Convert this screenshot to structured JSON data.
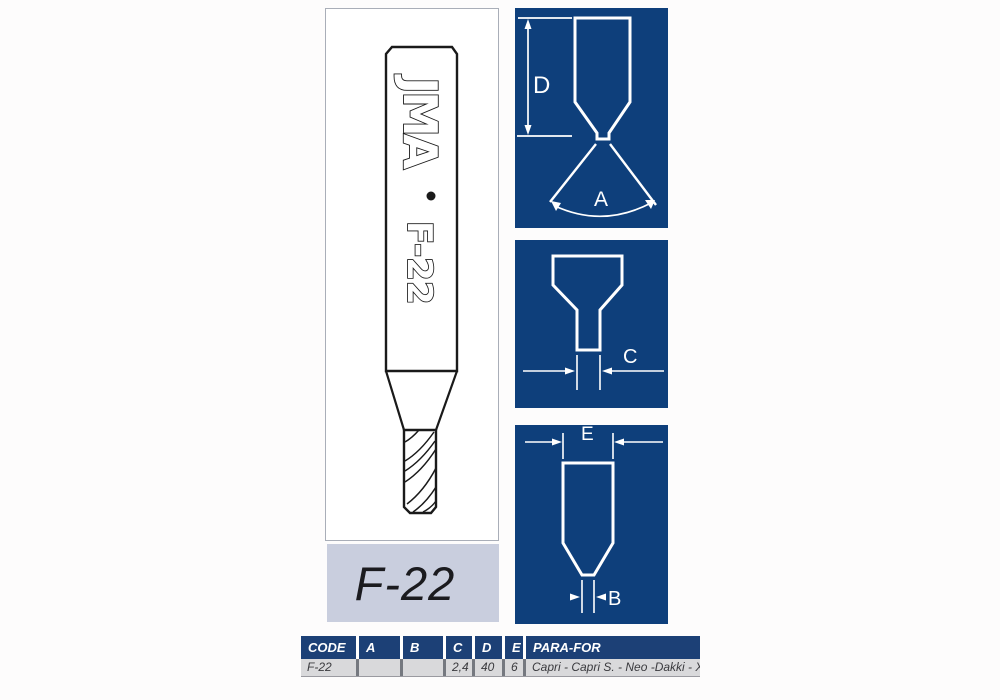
{
  "product": {
    "brand": "JMA",
    "model": "F-22",
    "code_label": "F-22"
  },
  "diagrams": {
    "panel_color": "#0e3f7b",
    "top": {
      "height_label": "D",
      "angle_label": "A"
    },
    "middle": {
      "width_label": "C"
    },
    "bottom": {
      "top_width_label": "E",
      "tip_width_label": "B"
    }
  },
  "spec_table": {
    "header_color": "#1c4076",
    "headers": [
      "CODE",
      "A",
      "B",
      "C",
      "D",
      "E",
      "PARA-FOR"
    ],
    "row": {
      "code": "F-22",
      "a": "",
      "b": "",
      "c": "2,4",
      "d": "40",
      "e": "6",
      "para_for": "Capri - Capri S. - Neo -Dakki - Xcode"
    }
  }
}
